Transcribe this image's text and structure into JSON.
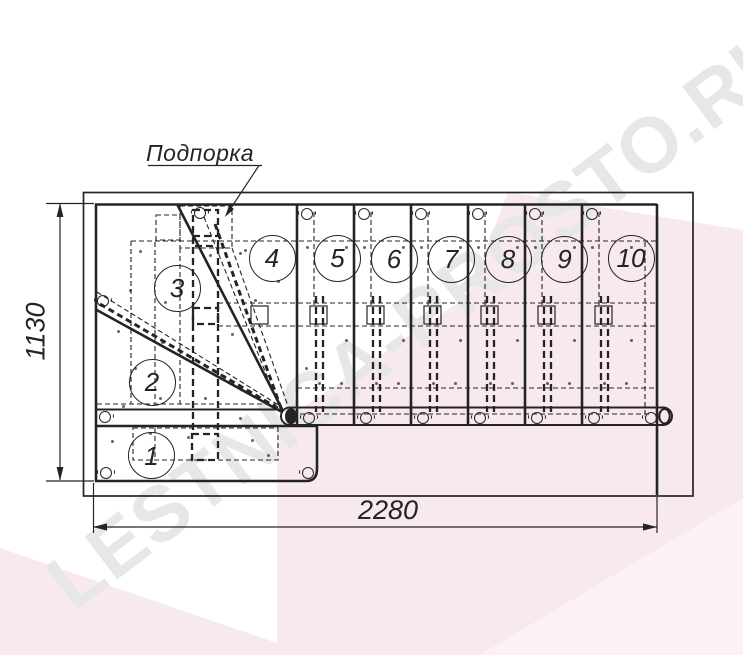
{
  "drawing": {
    "support_label": "Подпорка",
    "width_dimension": "2280",
    "height_dimension": "1130",
    "step_numbers": [
      "1",
      "2",
      "3",
      "4",
      "5",
      "6",
      "7",
      "8",
      "9",
      "10"
    ]
  },
  "watermark": {
    "text": "LESTNICA-PROSTO.RU"
  },
  "colors": {
    "line": "#242424",
    "background": "#ffffff",
    "watermark_pink": "#f8e9f1",
    "watermark_pink_light": "#fbf2f7",
    "watermark_gray": "#e9e6e8"
  }
}
